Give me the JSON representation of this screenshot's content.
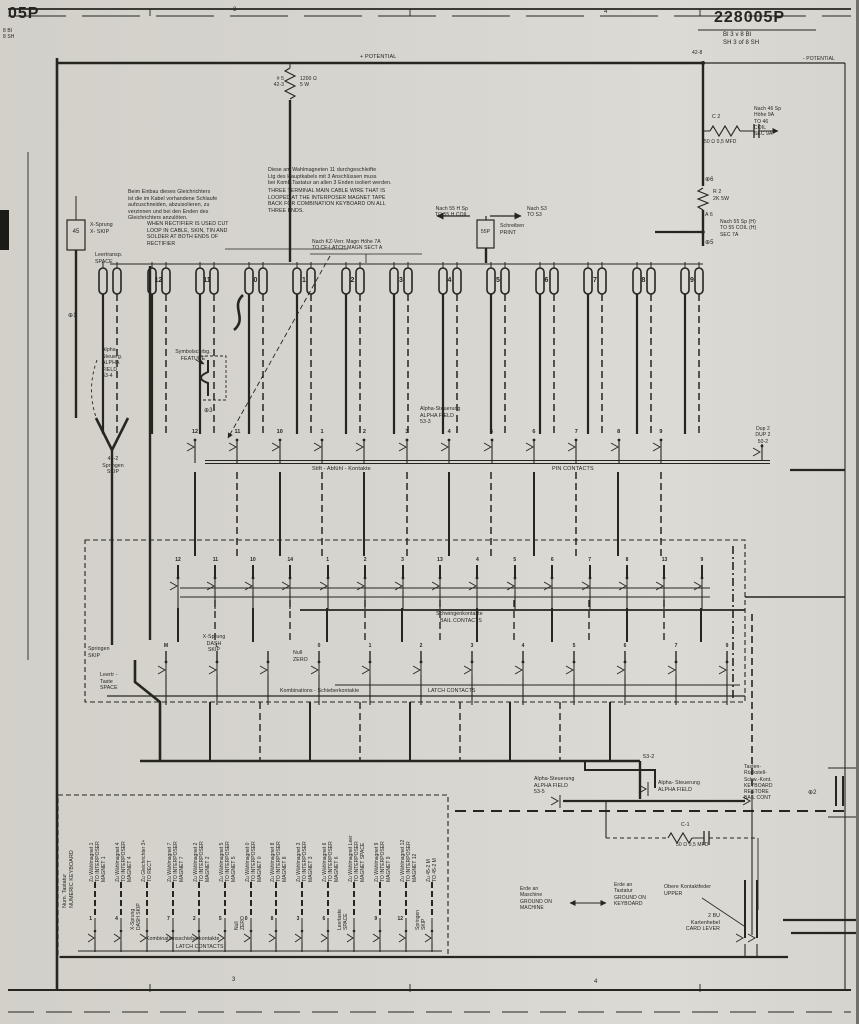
{
  "ink": "#26261f",
  "title_block": {
    "number": "228005P",
    "number_left": "05P",
    "sheet_de": "Bl 3 v 8 Bl",
    "sheet_en": "SH 3 of 8 SH",
    "sheet_left": "8 Bl\n8 SH",
    "zone_3_top": "3",
    "zone_4_top": "4",
    "zone_3_bottom": "3",
    "zone_4_bottom": "4"
  },
  "power": {
    "potential_top": "+ POTENTIAL",
    "potential_right": "- POTENTIAL",
    "node_42_8": "42-8"
  },
  "left_column": {
    "r1_ref": "# 5\n42-3",
    "r1_value": "1200 Ω\n5 W",
    "node_1": "⊕1",
    "relay_45": "45",
    "x_skip": "X-Sprung\nX- SKIP",
    "space": "Leertransp.\nSPACE"
  },
  "notes": {
    "rectifier_de": "Beim Einbau dieses Gleichrichters\nist die im Kabel vorhandene Schlaufe\naufzuschneiden, abzuisolieren, zu\nverzinnen und bei den Enden des\nGleichrichters anzulöten.",
    "rectifier_en": "WHEN RECTIFIER IS USED CUT\nLOOP IN CABLE, SKIN, TIN AND\nSOLDER AT BOTH ENDS OF\nRECTIFIER",
    "cable_de": "Diese am Wahlmagneten 11 durchgeschleifte\nLtg des Hauptkabels mit 3 Anschlüssen muss\nbei Komb.Tastatur an allen 3 Enden isoliert werden.",
    "cable_en": "THREE TERMINAL MAIN CABLE WIRE THAT IS\nLOOPED AT THE INTERPOSER MAGNET TAPE\nBACK FOR COMBINATION KEYBOARD ON ALL\nTHREE ENDS."
  },
  "connections": {
    "kz_latch": "Nach KZ-Verr. Magn Höhe 7A\nTO CF-LATCH MAGN SECT A",
    "to_55h_coil": "Nach 55 H Sp\nTO 55 H COIL",
    "to_s3": "Nach S3\nTO S3",
    "print_box": "55P",
    "print": "Schreiben\nPRINT"
  },
  "right_column": {
    "c2": "C 2",
    "c2_value": "50 Ω  0,5 MFD",
    "to_46_coil": "Nach 46 Sp\nHöhe 9A\nTO 46\nCOIL\nSEC 9A",
    "node_6": "⊕6",
    "r2": "R 2\n2K 5W",
    "node_a6": "A 6",
    "to_55_coil": "Nach 55 Sp (H)\nTO 55 COIL (H)\nSEC 7A",
    "node_5": "⊕5"
  },
  "magnet_row": {
    "numbers": [
      "",
      "12",
      "11",
      "0",
      "1",
      "2",
      "3",
      "4",
      "5",
      "6",
      "7",
      "8",
      "9"
    ]
  },
  "feature": {
    "alpha_53_4": "Alpha-\nSteuerg.\nALPHA\nFIELD\n53-4",
    "label": "Symbolschrbg.\nFEATURE",
    "node_3": "⊕3"
  },
  "pin_contacts": {
    "numbers": [
      "12",
      "11",
      "10",
      "1",
      "2",
      "3",
      "4",
      "5",
      "6",
      "7",
      "8",
      "9"
    ],
    "skip": "45-2\nSpringen\nSKIP",
    "alpha_53_3": "Alpha-Steuerung\nALPHA FIELD\n53-3",
    "label_de": "Stift -  Abfühl - Kontakte",
    "label_en": "PIN CONTACTS",
    "dup": "Dup 2\nDUP 2\n50-2"
  },
  "bail_contacts": {
    "numbers": [
      "12",
      "11",
      "10",
      "14",
      "1",
      "2",
      "3",
      "13",
      "4",
      "5",
      "6",
      "7",
      "8",
      "13",
      "9"
    ],
    "label_de": "Schwingenkontakte",
    "label_en": "BAIL CONTACTS"
  },
  "latch_contacts": {
    "numbers": [
      "M",
      "L",
      "",
      "0",
      "1",
      "2",
      "3",
      "4",
      "5",
      "6",
      "7",
      "9"
    ],
    "skip": "Springen\nSKIP",
    "space": "Leertr -\nTaste\nSPACE",
    "dash_skip": "X-Sprung\nDASH\nSKIP",
    "zero": "Null\nZERO",
    "label_de": "Kombinations - Schieberkontakte",
    "label_en": "LATCH CONTACTS"
  },
  "keyboard": {
    "title": "Num. Tastatur\nNUMERIC KEYBOARD",
    "items": [
      {
        "label": "Zu Wählmagnet 1\nTO INTERPOSER\nMAGNET 1",
        "pin": "1",
        "sub": ""
      },
      {
        "label": "Zu Wählmagnet 4\nTO INTERPOSER\nMAGNET 4",
        "pin": "4",
        "sub": ""
      },
      {
        "label": "Zu Gleichrichter 3+\nTO RECT",
        "pin": "",
        "sub": "X-Sprung\nDASH SKIP"
      },
      {
        "label": "Zu Wählmagnet 7\nTO INTERPOSER\nMAGNET 7",
        "pin": "7",
        "sub": ""
      },
      {
        "label": "Zu Wählmagnet 2\nTO INTERPOSER\nMAGNET 2",
        "pin": "2",
        "sub": ""
      },
      {
        "label": "Zu Wählmagnet 5\nTO INTERPOSER\nMAGNET 5",
        "pin": "5",
        "sub": ""
      },
      {
        "label": "Zu Wählmagnet 0\nTO INTERPOSER\nMAGNET 0",
        "pin": "0",
        "sub": "Null\nZERO"
      },
      {
        "label": "Zu Wählmagnet 8\nTO INTERPOSER\nMAGNET 8",
        "pin": "8",
        "sub": ""
      },
      {
        "label": "Zu Wählmagnet 3\nTO INTERPOSER\nMAGNET 3",
        "pin": "3",
        "sub": ""
      },
      {
        "label": "Zu Wählmagnet 6\nTO INTERPOSER\nMAGNET 6",
        "pin": "6",
        "sub": ""
      },
      {
        "label": "Zu Wählmagnet Leer\nTO INTERPOSER\nMAGNET SPACE",
        "pin": "",
        "sub": "Leertaste\nSPACE"
      },
      {
        "label": "Zu Wählmagnet 9\nTO INTERPOSER\nMAGNET 9",
        "pin": "9",
        "sub": ""
      },
      {
        "label": "Zu Wählmagnet 12\nTO INTERPOSER\nMAGNET 12",
        "pin": "12",
        "sub": ""
      },
      {
        "label": "Zu 45-2 M\nTO 45-2 M",
        "pin": "",
        "sub": "Springen\nSKIP"
      }
    ],
    "label_de": "Kombinationsschieberkontakte",
    "label_en": "LATCH CONTACTS"
  },
  "bottom": {
    "alpha_53_5": "Alpha-Steuerung\nALPHA FIELD\n53-5",
    "ref_53_2": "53-2",
    "alpha_53_2": "Alpha- Steuerung\nALPHA FIELD",
    "restore": "Tasten-\nRückstell-\nSchw.-Kont.\nKEYBOARD\nRESTORE\nBAIL CONT",
    "node_2": "⊕2",
    "c1": "C-1",
    "c1_value": "50 Ω   0,5 MFD",
    "ground_machine": "Erde an\nMaschine\nGROUND ON\nMACHINE",
    "ground_keyboard": "Erde an\nTastatur\nGROUND ON\nKEYBOARD",
    "upper": "Obere Kontaktfeder\nUPPER",
    "card_lever": "2 BU\nKartenhebel\nCARD LEVER"
  }
}
